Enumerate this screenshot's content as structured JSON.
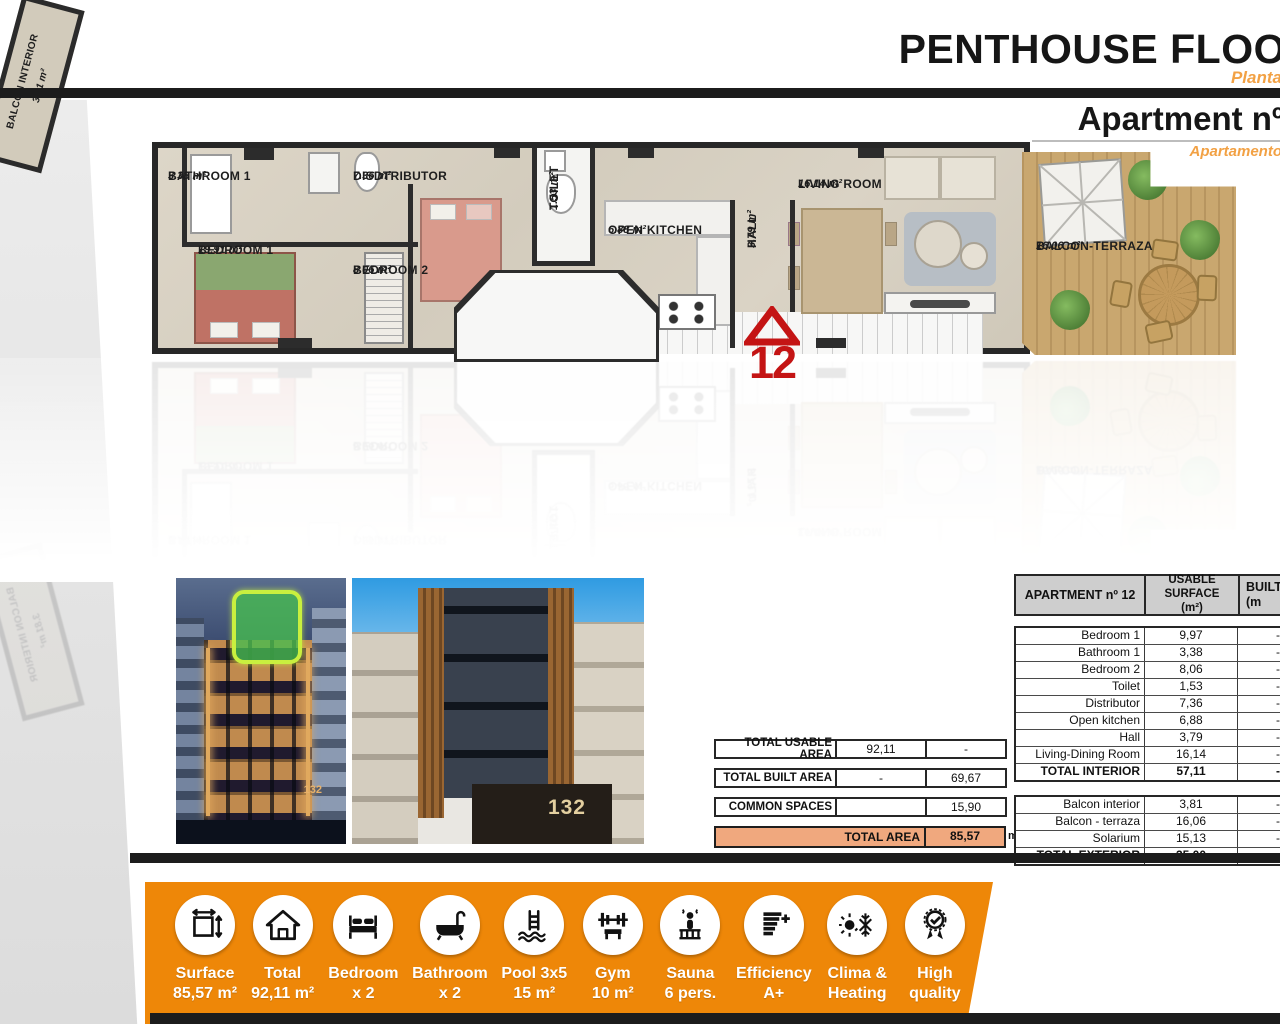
{
  "header": {
    "title": "PENTHOUSE FLOO",
    "subtitle": "Planta",
    "apartment_title": "Apartment nº",
    "apartment_subtitle": "Apartamento"
  },
  "floor_plan": {
    "marker_number": "12",
    "rooms": {
      "bathroom1": {
        "name": "BATHROOM 1",
        "area": "3.38 m²"
      },
      "bedroom1": {
        "name": "BEDROOM 1",
        "area": "19.91 m²"
      },
      "distributor": {
        "name": "DISDTRIBUTOR",
        "area": "7.36 m²"
      },
      "bedroom2": {
        "name": "BEDROOM 2",
        "area": "8.06 m²"
      },
      "toilet": {
        "name": "TOILET",
        "area": "1.53 m²"
      },
      "open_kitchen": {
        "name": "OPEN KITCHEN",
        "area": "6.88 m²"
      },
      "hall": {
        "name": "HALL",
        "area": "3.79 m²"
      },
      "living_room": {
        "name": "LIVING ROOM",
        "area": "16.14 m²"
      },
      "balcon_interior": {
        "name": "BALCON INTERIOR",
        "area": "3.81 m²"
      },
      "balcon_terraza": {
        "name": "BALCON-TERRAZA",
        "area": "16.06 m²"
      }
    }
  },
  "photos": {
    "night": {
      "number": "132"
    },
    "day": {
      "number": "132"
    }
  },
  "summary_table": {
    "rows": [
      {
        "label": "TOTAL USABLE AREA",
        "usable": "92,11",
        "built": "-"
      },
      {
        "label": "TOTAL BUILT AREA",
        "usable": "-",
        "built": "69,67"
      },
      {
        "label": "COMMON SPACES",
        "usable": "",
        "built": "15,90"
      }
    ],
    "total_row": {
      "label": "TOTAL AREA",
      "value": "85,57",
      "unit": "m²"
    }
  },
  "area_table": {
    "header": {
      "col1": "APARTMENT nº 12",
      "col2_line1": "USABLE SURFACE",
      "col2_line2": "(m²)",
      "col3_line1": "BUILT",
      "col3_line2": "(m"
    },
    "interior_rows": [
      {
        "label": "Bedroom 1",
        "usable": "9,97",
        "built": "-"
      },
      {
        "label": "Bathroom 1",
        "usable": "3,38",
        "built": "-"
      },
      {
        "label": "Bedroom 2",
        "usable": "8,06",
        "built": "-"
      },
      {
        "label": "Toilet",
        "usable": "1,53",
        "built": "-"
      },
      {
        "label": "Distributor",
        "usable": "7,36",
        "built": "-"
      },
      {
        "label": "Open kitchen",
        "usable": "6,88",
        "built": "-"
      },
      {
        "label": "Hall",
        "usable": "3,79",
        "built": "-"
      },
      {
        "label": "Living-Dining Room",
        "usable": "16,14",
        "built": "-"
      },
      {
        "label": "TOTAL INTERIOR",
        "usable": "57,11",
        "built": "-"
      }
    ],
    "exterior_rows": [
      {
        "label": "Balcon interior",
        "usable": "3,81",
        "built": "-"
      },
      {
        "label": "Balcon - terraza",
        "usable": "16,06",
        "built": "-"
      },
      {
        "label": "Solarium",
        "usable": "15,13",
        "built": "-"
      },
      {
        "label": "TOTAL EXTERIOR",
        "usable": "35,00",
        "built": "-"
      }
    ]
  },
  "features": [
    {
      "icon": "surface-icon",
      "line1": "Surface",
      "line2": "85,57 m²"
    },
    {
      "icon": "house-icon",
      "line1": "Total",
      "line2": "92,11 m²"
    },
    {
      "icon": "bed-icon",
      "line1": "Bedroom",
      "line2": "x 2"
    },
    {
      "icon": "bathtub-icon",
      "line1": "Bathroom",
      "line2": "x 2"
    },
    {
      "icon": "pool-icon",
      "line1": "Pool 3x5",
      "line2": "15 m²"
    },
    {
      "icon": "gym-icon",
      "line1": "Gym",
      "line2": "10 m²"
    },
    {
      "icon": "sauna-icon",
      "line1": "Sauna",
      "line2": "6 pers."
    },
    {
      "icon": "efficiency-icon",
      "line1": "Efficiency",
      "line2": "A+"
    },
    {
      "icon": "climate-icon",
      "line1": "Clima &",
      "line2": "Heating"
    },
    {
      "icon": "quality-icon",
      "line1": "High",
      "line2": "quality"
    }
  ],
  "colors": {
    "accent_orange": "#ee8708",
    "subtitle_orange": "#f2a144",
    "total_area_bg": "#f0a87e",
    "marker_red": "#c41414",
    "table_header_bg": "#cecece"
  }
}
